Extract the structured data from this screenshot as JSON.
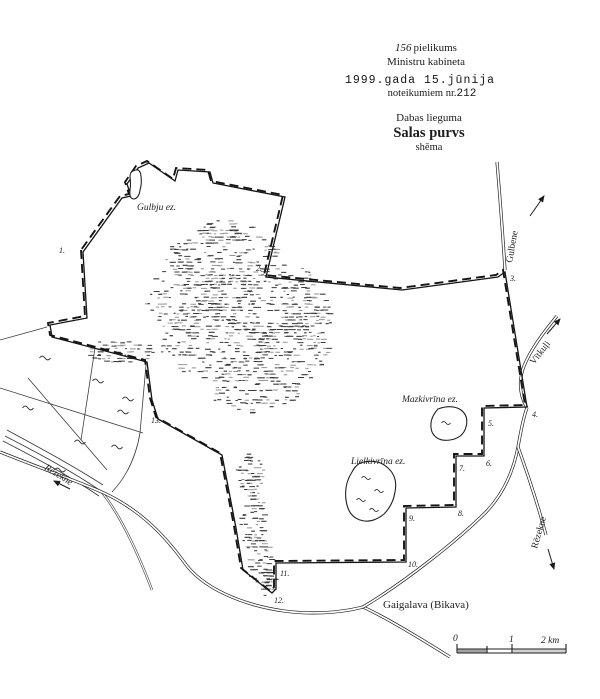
{
  "header": {
    "annex_number": "156",
    "annex_word": "pielikums",
    "ministry": "Ministru kabineta",
    "date_line": "1999.gada 15.jūnija",
    "regulation_prefix": "noteikumiem nr.",
    "regulation_number": "212",
    "category": "Dabas lieguma",
    "title": "Salas purvs",
    "doc_type": "shēma"
  },
  "map": {
    "lakes": [
      {
        "label": "Gulbju ez."
      },
      {
        "label": "Mazkivrīna ez."
      },
      {
        "label": "Lielkivrīna ez."
      }
    ],
    "roads": {
      "gulbene": "Gulbene",
      "vitkuli": "Vītkuļi",
      "rezekne_road": "Rēzekne",
      "rezekne_river": "Rēzekne",
      "gaigalava": "Gaigalava (Bikava)"
    },
    "boundary_points": [
      "1.",
      "2.",
      "3.",
      "4.",
      "5.",
      "6.",
      "7.",
      "8.",
      "9.",
      "10.",
      "11.",
      "12.",
      "13."
    ],
    "scale": {
      "tick0": "0",
      "tick1": "1",
      "tick2": "2 km"
    }
  },
  "icons": {
    "direction_arrow": "triangle-arrowhead"
  },
  "colors": {
    "ink": "#1c1c1c",
    "paper": "#ffffff"
  }
}
